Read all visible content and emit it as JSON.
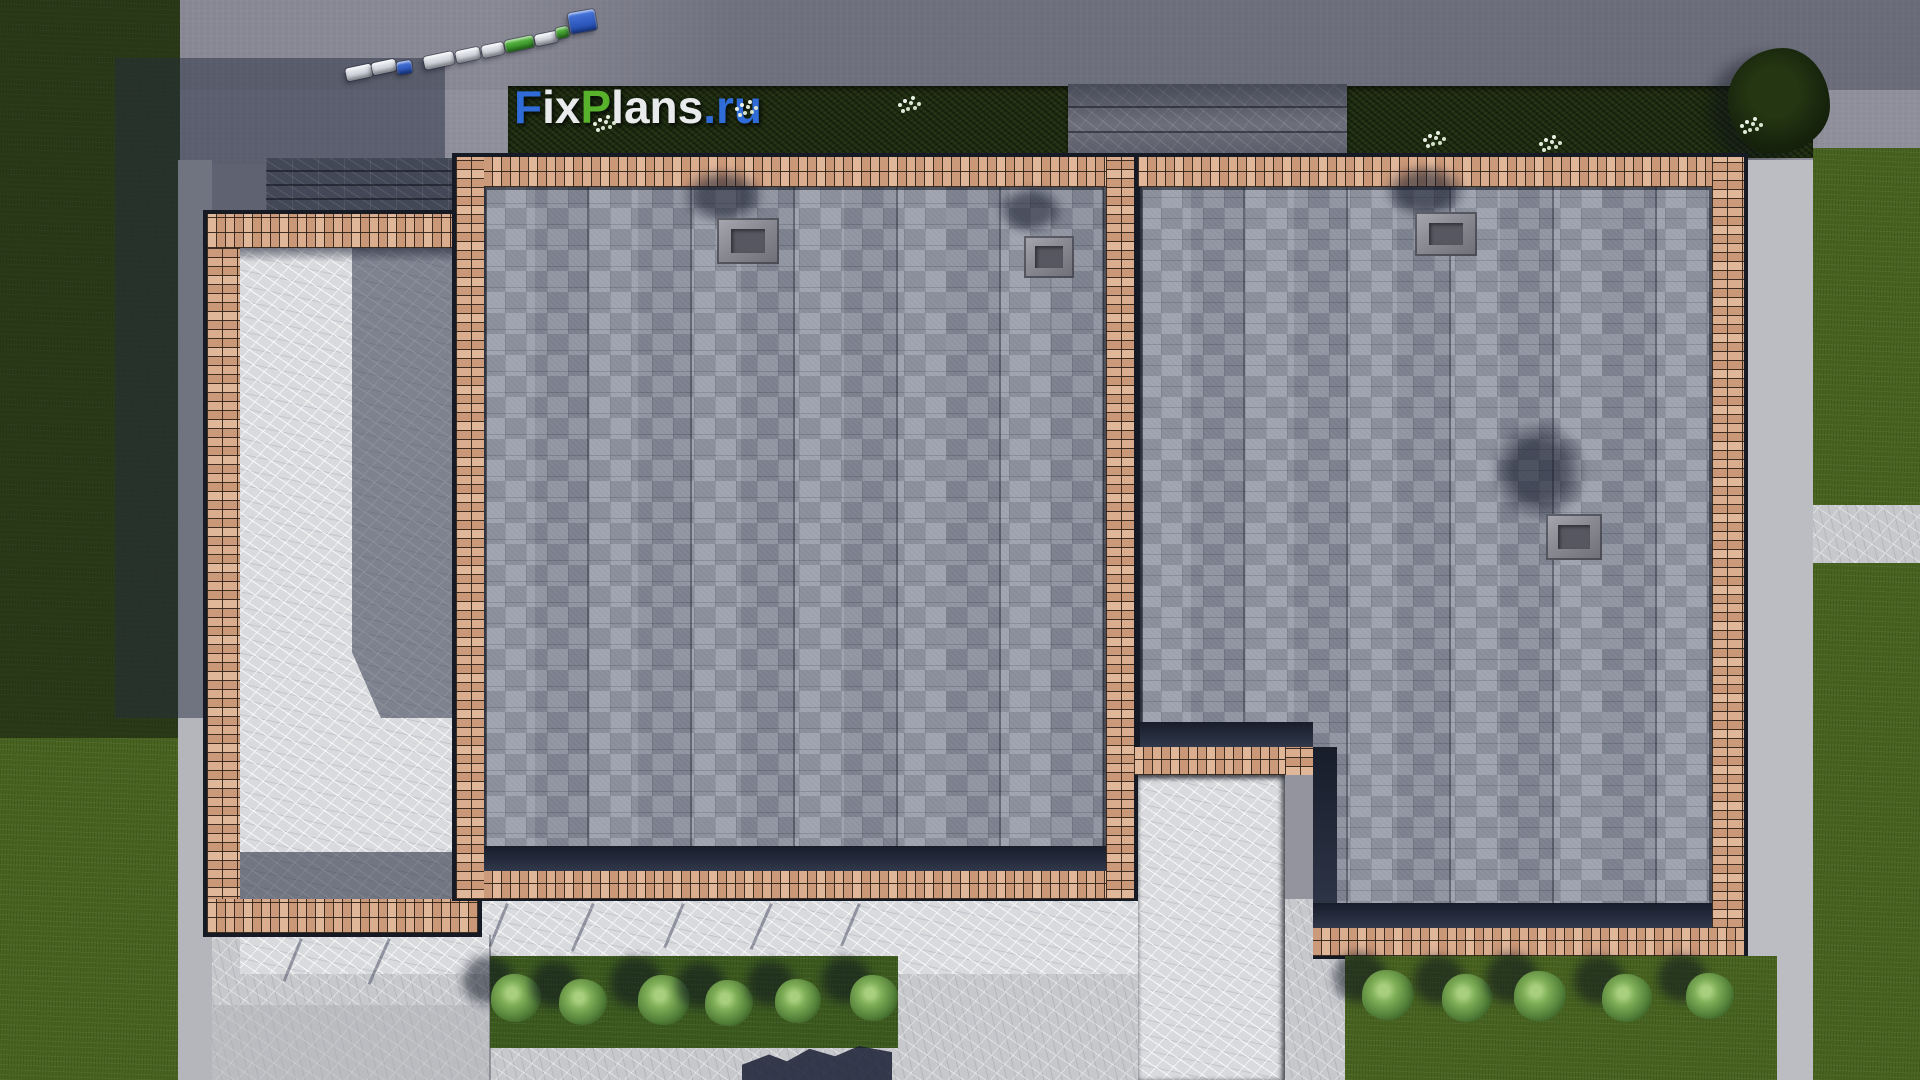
{
  "watermark": {
    "text": "FixPlans.ru",
    "parts": [
      {
        "text": "F",
        "color": "#2f6cd8"
      },
      {
        "text": "ix",
        "color": "#e9eaec"
      },
      {
        "text": "P",
        "color": "#58b22c"
      },
      {
        "text": "lans",
        "color": "#e9eaec"
      },
      {
        "text": ".ru",
        "color": "#2f6cd8"
      }
    ]
  },
  "palette": {
    "brand_blue": "#2f6cd8",
    "brand_green": "#58b22c",
    "brick": "#d9a888",
    "roof_shingle": "#8b8f9b",
    "asphalt": "#8f8f9b",
    "concrete": "#c7c8cc",
    "concrete_bright": "#d9dade",
    "grass": "#47631f",
    "hedge": "#202e12",
    "outline": "#151a24",
    "car_silver": "#dfe2e8",
    "car_blue": "#2b58c8",
    "car_green": "#3fa32e"
  },
  "scene": {
    "cars": [
      {
        "x": 346,
        "y": 66,
        "w": 26,
        "h": 13,
        "color": "silver",
        "angle": -12
      },
      {
        "x": 372,
        "y": 61,
        "w": 24,
        "h": 12,
        "color": "silver",
        "angle": -12
      },
      {
        "x": 397,
        "y": 61,
        "w": 15,
        "h": 13,
        "color": "blue",
        "angle": -10
      },
      {
        "x": 424,
        "y": 54,
        "w": 30,
        "h": 13,
        "color": "silver",
        "angle": -12
      },
      {
        "x": 456,
        "y": 49,
        "w": 24,
        "h": 12,
        "color": "silver",
        "angle": -12
      },
      {
        "x": 482,
        "y": 44,
        "w": 22,
        "h": 12,
        "color": "silver",
        "angle": -12
      },
      {
        "x": 505,
        "y": 38,
        "w": 29,
        "h": 12,
        "color": "green",
        "angle": -12
      },
      {
        "x": 535,
        "y": 33,
        "w": 23,
        "h": 11,
        "color": "silver",
        "angle": -12
      },
      {
        "x": 556,
        "y": 27,
        "w": 13,
        "h": 11,
        "color": "green",
        "angle": -12
      },
      {
        "x": 569,
        "y": 11,
        "w": 27,
        "h": 21,
        "color": "blue",
        "angle": -10
      }
    ],
    "bushes_front": [
      [
        516,
        999,
        50
      ],
      [
        583,
        1003,
        48
      ],
      [
        664,
        1001,
        52
      ],
      [
        729,
        1004,
        48
      ],
      [
        798,
        1002,
        46
      ],
      [
        874,
        999,
        48
      ]
    ],
    "bushes_right": [
      [
        1388,
        996,
        52
      ],
      [
        1467,
        999,
        50
      ],
      [
        1540,
        997,
        52
      ],
      [
        1627,
        999,
        50
      ],
      [
        1710,
        997,
        48
      ]
    ],
    "chimneys": [
      {
        "body": [
          717,
          218,
          62,
          46
        ],
        "smudge": [
          682,
          168,
          82,
          56
        ]
      },
      {
        "body": [
          1024,
          236,
          50,
          42
        ],
        "smudge": [
          997,
          186,
          66,
          48
        ]
      },
      {
        "body": [
          1415,
          212,
          62,
          44
        ],
        "smudge": [
          1384,
          164,
          82,
          54
        ]
      },
      {
        "body": [
          1546,
          514,
          56,
          46
        ],
        "smudge": [
          1492,
          422,
          94,
          98
        ]
      }
    ],
    "flower_clusters": [
      [
        598,
        118
      ],
      [
        740,
        103
      ],
      [
        903,
        99
      ],
      [
        1428,
        134
      ],
      [
        1544,
        138
      ],
      [
        1745,
        120
      ]
    ],
    "post_shadows": [
      [
        300,
        938,
        46,
        22
      ],
      [
        388,
        938,
        50,
        24
      ],
      [
        506,
        903,
        46,
        22
      ],
      [
        592,
        903,
        52,
        24
      ],
      [
        682,
        903,
        48,
        23
      ],
      [
        770,
        903,
        50,
        24
      ],
      [
        858,
        903,
        46,
        23
      ]
    ]
  }
}
